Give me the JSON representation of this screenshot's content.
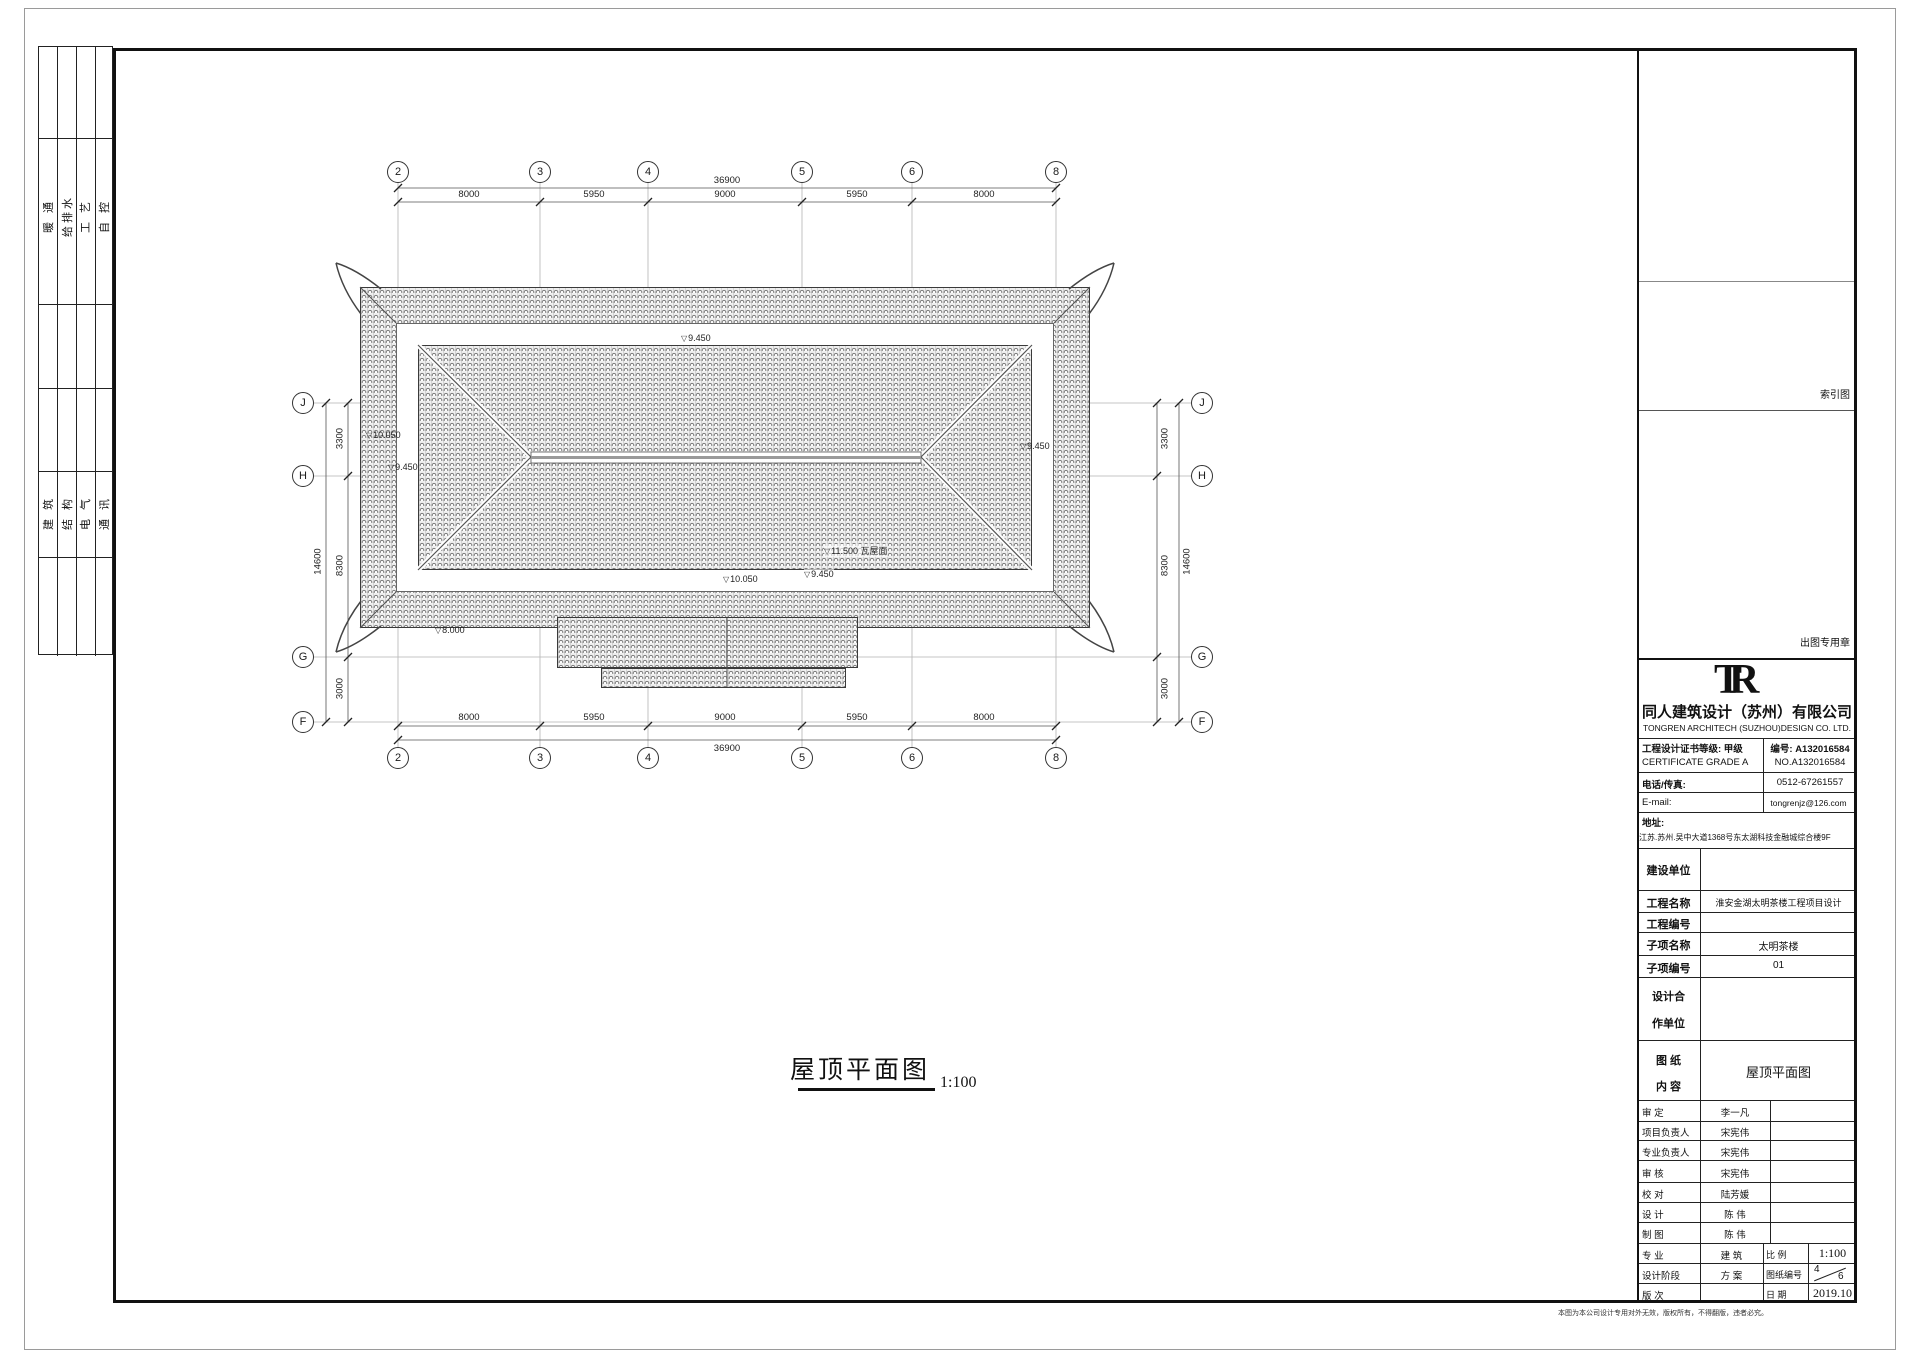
{
  "symbols": {
    "elevation": "▽"
  },
  "sheet": {
    "binding_strips": {
      "strip1": [
        "暖 通",
        "给排水",
        "工 艺",
        "自 控"
      ],
      "strip2": [
        "建 筑",
        "结 构",
        "电 气",
        "通 讯"
      ]
    },
    "footer_note": "本图为本公司设计专用对外无效，版权所有，不得翻版，违者必究。"
  },
  "drawing": {
    "title": "屋顶平面图",
    "scale": "1:100",
    "axes_top": [
      "2",
      "3",
      "4",
      "5",
      "6",
      "8"
    ],
    "axes_left": [
      "J",
      "H",
      "G",
      "F"
    ],
    "dims_top": [
      "8000",
      "5950",
      "9000",
      "5950",
      "8000"
    ],
    "dims_top_total": "36900",
    "dims_bottom": [
      "8000",
      "5950",
      "9000",
      "5950",
      "8000"
    ],
    "dims_bottom_total": "36900",
    "dims_left": [
      "3300",
      "8300",
      "3000"
    ],
    "dims_left_total": "14600",
    "dims_right": [
      "3300",
      "8300",
      "3000"
    ],
    "dims_right_total": "14600",
    "elevations": {
      "top": "9.450",
      "left_upper": "10.050",
      "left_lower": "9.450",
      "right_mid": "9.450",
      "bottom_center": "10.050",
      "bottom_right": "9.450",
      "porch": "8.000",
      "ridge": "11.500 瓦屋面"
    }
  },
  "title_block": {
    "index_label": "索引图",
    "stamp_label": "出图专用章",
    "logo": "TR",
    "company_cn": "同人建筑设计（苏州）有限公司",
    "company_en": "TONGREN ARCHITECH (SUZHOU)DESIGN CO. LTD.",
    "cert_cn": "工程设计证书等级: 甲级",
    "cert_no_cn": "编号: A132016584",
    "cert_en": "CERTIFICATE GRADE A",
    "cert_no_en": "NO.A132016584",
    "tel_label": "电话/传真:",
    "tel_value": "0512-67261557",
    "email_label": "E-mail:",
    "email_value": "tongrenjz@126.com",
    "addr_label": "地址:",
    "addr_value": "江苏.苏州.吴中大道1368号东太湖科技金融城综合楼9F",
    "rows": [
      {
        "label": "建设单位",
        "value": ""
      },
      {
        "label": "工程名称",
        "value": "淮安金湖太明茶楼工程项目设计"
      },
      {
        "label": "工程编号",
        "value": ""
      },
      {
        "label": "子项名称",
        "value": "太明茶楼"
      },
      {
        "label": "子项编号",
        "value": "01"
      }
    ],
    "coop_label_1": "设计合",
    "coop_label_2": "作单位",
    "content_label_1": "图  纸",
    "content_label_2": "内  容",
    "content_value": "屋顶平面图",
    "sign_rows": [
      {
        "label": "审  定",
        "value": "李一凡"
      },
      {
        "label": "项目负责人",
        "value": "宋宪伟"
      },
      {
        "label": "专业负责人",
        "value": "宋宪伟"
      },
      {
        "label": "审  核",
        "value": "宋宪伟"
      },
      {
        "label": "校  对",
        "value": "陆芳媛"
      },
      {
        "label": "设  计",
        "value": "陈 伟"
      },
      {
        "label": "制  图",
        "value": "陈 伟"
      }
    ],
    "meta": {
      "specialty_label": "专  业",
      "specialty": "建 筑",
      "scale_label": "比  例",
      "scale": "1:100",
      "stage_label": "设计阶段",
      "stage": "方 案",
      "sheetno_label": "图纸编号",
      "sheetno_num": "4",
      "sheetno_den": "6",
      "version_label": "版  次",
      "version": "",
      "date_label": "日  期",
      "date": "2019.10"
    }
  }
}
